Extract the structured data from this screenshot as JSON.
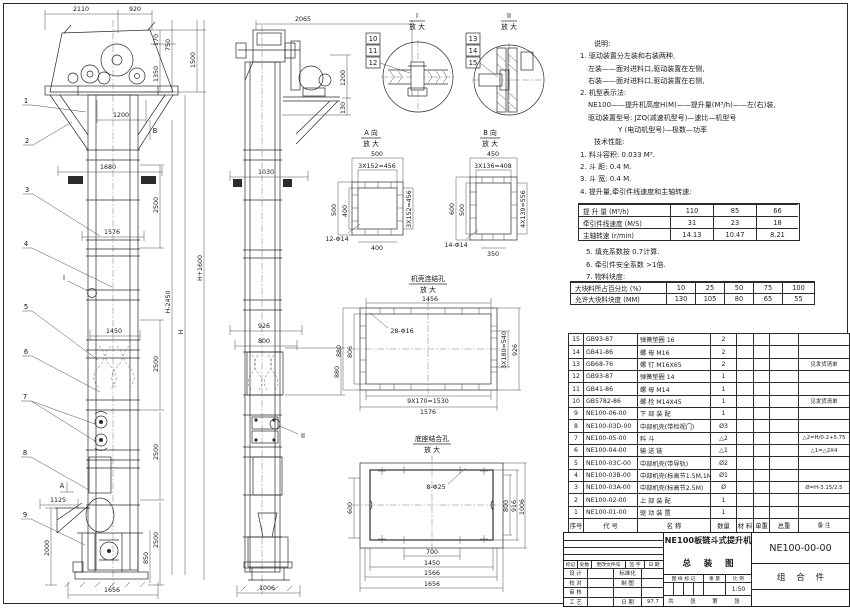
{
  "front": {
    "dims": {
      "d2110": "2110",
      "d920": "920",
      "d170": "170",
      "d750": "750",
      "d1350": "1350",
      "d1500": "1500",
      "d1200": "1200",
      "d1680": "1680",
      "d1576": "1576",
      "d1450": "1450",
      "d2500": "2500",
      "dH1600": "H+1600",
      "dH": "H",
      "dH2450": "H-2450",
      "d1125": "1125",
      "d2000": "2000",
      "d850": "850",
      "d1656": "1656"
    },
    "balloons": [
      "1",
      "2",
      "3",
      "4",
      "5",
      "6",
      "7",
      "8",
      "9"
    ],
    "markers": {
      "a": "A",
      "b": "B",
      "i": "I"
    }
  },
  "side": {
    "dims": {
      "d2065": "2065",
      "d1200": "1200",
      "d130": "130",
      "d1030": "1030",
      "d926": "926",
      "d800": "800",
      "d880": "880",
      "d1006": "1006"
    },
    "marker_ii": "II"
  },
  "details": {
    "i": {
      "no": "I",
      "mag": "放 大",
      "balloons": [
        "10",
        "11",
        "12"
      ]
    },
    "ii": {
      "no": "II",
      "mag": "放 大",
      "balloons": [
        "13",
        "14",
        "15"
      ]
    }
  },
  "view_a": {
    "no": "A 向",
    "mag": "放 大",
    "dims": {
      "top": "500",
      "topin": "3X152=456",
      "left": "500",
      "leftin": "400",
      "right": "3X152=456",
      "bottom": "400",
      "holes": "12-Φ14"
    }
  },
  "view_b": {
    "no": "B 向",
    "mag": "放 大",
    "dims": {
      "top": "450",
      "topin": "3X136=408",
      "left": "600",
      "leftin": "500",
      "right": "4X139=556",
      "bottom": "350",
      "holes": "14-Φ14"
    }
  },
  "casing": {
    "title": "机壳连结孔",
    "mag": "放 大",
    "dims": {
      "top": "1456",
      "holes": "28-Φ16",
      "left": "880",
      "leftin": "806",
      "rightin": "3X180=540",
      "right": "926",
      "bottomin": "9X170=1530",
      "bottom": "1576"
    }
  },
  "base": {
    "title": "底座结合孔",
    "mag": "放 大",
    "dims": {
      "holes": "8-Φ25",
      "left": "600",
      "r1": "800",
      "r2": "916",
      "r3": "1006",
      "b1": "700",
      "b2": "1450",
      "b3": "1566",
      "b4": "1656"
    }
  },
  "notes": {
    "heading": "说明:",
    "items": [
      "1. 驱动装置分左装和右装两种,",
      "左装——面对进料口,驱动装置在左侧,",
      "右装——面对进料口,驱动装置在右侧,",
      "2. 机型表示法:",
      "NE100——提升机高度H(M)——提升量(M³/h)——左(右)装,",
      "驱动装置型号: JZQ(减速机型号)—速比—机型号",
      "Y (电动机型号)—极数—功率"
    ],
    "tech_heading": "技术性能:",
    "tech_items": [
      "1. 料斗容积: 0.033 M³.",
      "2. 斗  距: 0.4 M.",
      "3. 斗  宽: 0.4 M.",
      "4. 提升量,牵引件线速度和主轴转速:"
    ],
    "tech_items2": [
      "5. 填充系数按 0.7计算.",
      "6. 牵引件安全系数 >1倍.",
      "7. 物料块度:"
    ]
  },
  "spec_table": {
    "rows": [
      [
        "提 升 量  (M³/h)",
        "110",
        "85",
        "66"
      ],
      [
        "牵引件线速度 (M/S)",
        "31",
        "23",
        "18"
      ],
      [
        "主轴转速 (r/min)",
        "14.13",
        "10.47",
        "8.21"
      ]
    ]
  },
  "lump_table": {
    "rows": [
      [
        "大块料所占百分比 (%)",
        "10",
        "25",
        "50",
        "75",
        "100"
      ],
      [
        "允许大块料块度 (MM)",
        "130",
        "105",
        "80",
        "65",
        "55"
      ]
    ]
  },
  "parts": {
    "header": [
      "序号",
      "代  号",
      "名    称",
      "数量",
      "材 料",
      "单重",
      "总重",
      "备 注"
    ],
    "rows": [
      [
        "15",
        "GB93-87",
        "弹簧垫圈 16",
        "2",
        "",
        "",
        "",
        ""
      ],
      [
        "14",
        "GB41-86",
        "螺  母  M16",
        "2",
        "",
        "",
        "",
        ""
      ],
      [
        "13",
        "GB68-76",
        "螺  钉  M16X65",
        "2",
        "",
        "",
        "",
        "见发货清单"
      ],
      [
        "12",
        "GB93-87",
        "弹簧垫圈 14",
        "1",
        "",
        "",
        "",
        ""
      ],
      [
        "11",
        "GB41-86",
        "螺  母  M14",
        "1",
        "",
        "",
        "",
        ""
      ],
      [
        "10",
        "GB5782-86",
        "螺  栓  M14X45",
        "1",
        "",
        "",
        "",
        "见发货清单"
      ],
      [
        "9",
        "NE100-06-00",
        "下 部 装 配",
        "1",
        "",
        "",
        "",
        ""
      ],
      [
        "8",
        "NE100-03D-00",
        "中部机壳(带检视门)",
        "Ø3",
        "",
        "",
        "",
        ""
      ],
      [
        "7",
        "NE100-05-00",
        "料  斗",
        "△2",
        "",
        "",
        "",
        "△2=H/0.2+5.75"
      ],
      [
        "6",
        "NE100-04-00",
        "输 送 链",
        "△1",
        "",
        "",
        "",
        "△1=△2X4"
      ],
      [
        "5",
        "NE100-03C-00",
        "中部机壳(带导轨)",
        "Ø2",
        "",
        "",
        "",
        ""
      ],
      [
        "4",
        "NE100-03B-00",
        "中部机壳(标高节1.5M,1M)",
        "Ø1",
        "",
        "",
        "",
        ""
      ],
      [
        "3",
        "NE100-03A-00",
        "中部机壳(标高节2.5M)",
        "Ø",
        "",
        "",
        "",
        "Ø=H-3.15/2.5"
      ],
      [
        "2",
        "NE100-02-00",
        "上 部 装 配",
        "1",
        "",
        "",
        "",
        ""
      ],
      [
        "1",
        "NE100-01-00",
        "驱 动 装 置",
        "1",
        "",
        "",
        "",
        ""
      ]
    ]
  },
  "title_block": {
    "rev_header": [
      "标记",
      "处数",
      "更改文件号",
      "签 字",
      "日 期"
    ],
    "sig_rows": [
      [
        "设 计",
        "",
        "标准化",
        ""
      ],
      [
        "校 对",
        "",
        "制 图",
        ""
      ],
      [
        "审 核",
        "",
        "",
        ""
      ],
      [
        "工 艺",
        "",
        "日 期",
        "97.7"
      ]
    ],
    "title_line1": "NE100板链斗式提升机",
    "title_line2": "总 装 图",
    "stamp_header": [
      "图 样 标 记",
      "重 量",
      "比 例"
    ],
    "scale": "1:50",
    "sheet_note": [
      "共",
      "张",
      "第",
      "张"
    ],
    "drawing_no": "NE100-00-00",
    "part_type": "组 合 件"
  }
}
